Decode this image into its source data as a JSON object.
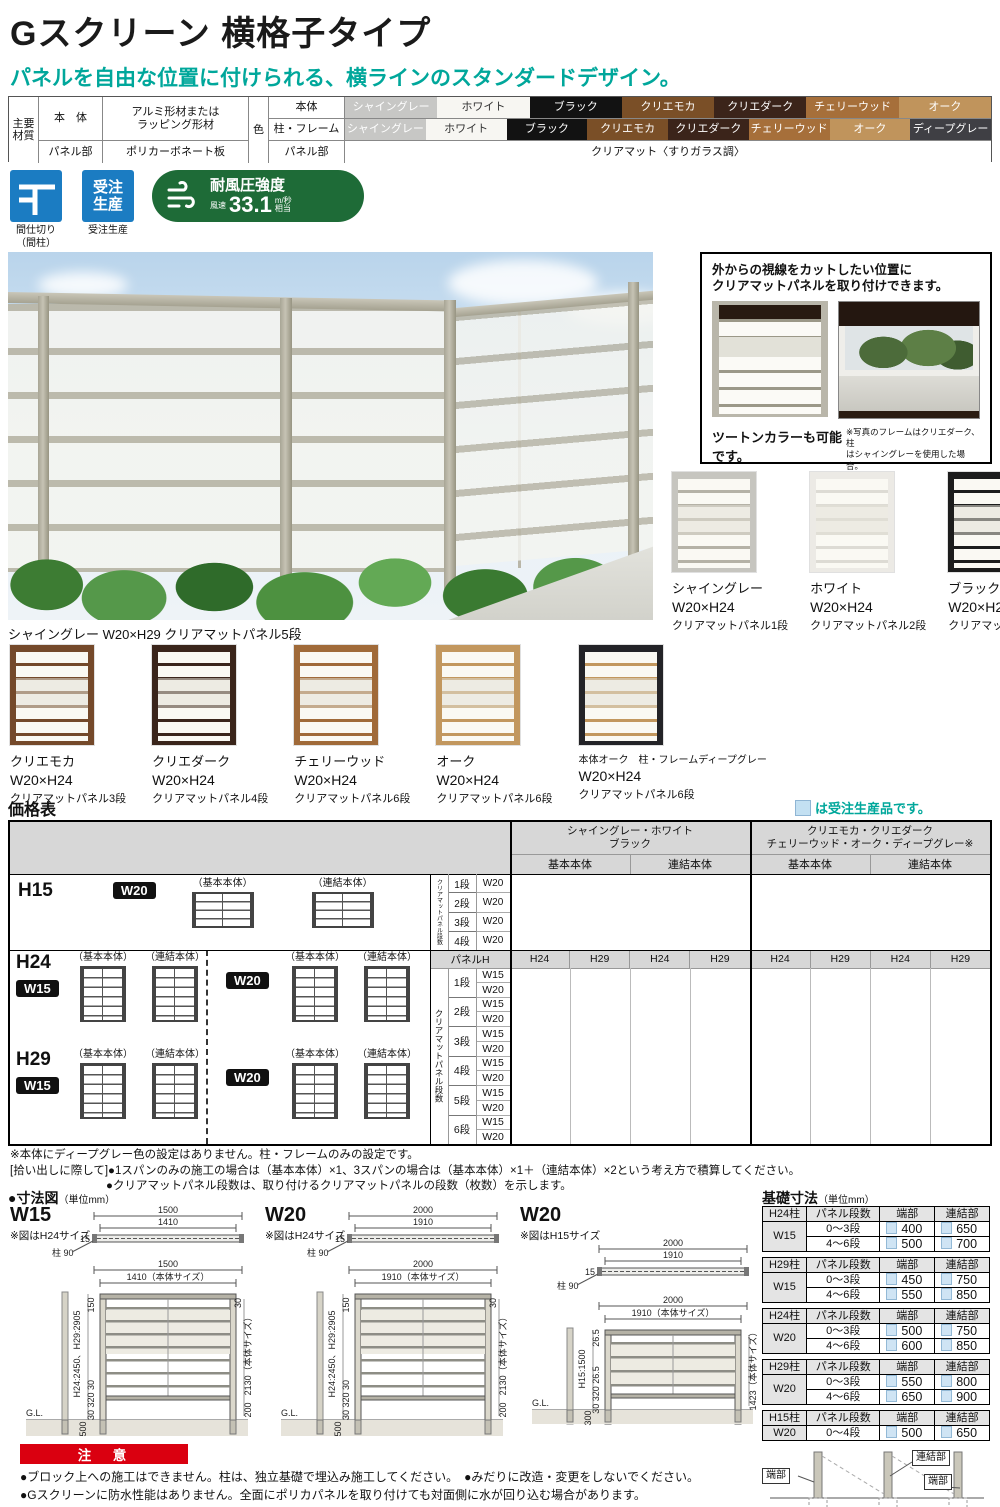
{
  "header": {
    "title": "Gスクリーン 横格子タイプ",
    "subtitle": "パネルを自由な位置に付けられる、横ラインのスタンダードデザイン。"
  },
  "spec": {
    "main_l1": "主要",
    "main_l2": "材質",
    "body_label": "本　体",
    "body_value_l1": "アルミ形材または",
    "body_value_l2": "ラッピング形材",
    "panel_label": "パネル部",
    "panel_value": "ポリカーボネート板",
    "color_label": "色",
    "row1_label": "本体",
    "row2_label": "柱・フレーム",
    "row3_label": "パネル部",
    "row3_value": "クリアマット〈すりガラス調〉",
    "row1": [
      {
        "name": "シャイングレー",
        "bg": "#c7c7c5",
        "fg": "#ffffff"
      },
      {
        "name": "ホワイト",
        "bg": "#f7f6f2",
        "fg": "#333333"
      },
      {
        "name": "ブラック",
        "bg": "#121212",
        "fg": "#ffffff"
      },
      {
        "name": "クリエモカ",
        "bg": "#7a4f27",
        "fg": "#ffffff"
      },
      {
        "name": "クリエダーク",
        "bg": "#3b241a",
        "fg": "#ffffff"
      },
      {
        "name": "チェリーウッド",
        "bg": "#a66f3a",
        "fg": "#ffffff"
      },
      {
        "name": "オーク",
        "bg": "#c0945c",
        "fg": "#ffffff"
      }
    ],
    "row2": [
      {
        "name": "シャイングレー",
        "bg": "#c7c7c5",
        "fg": "#ffffff"
      },
      {
        "name": "ホワイト",
        "bg": "#f7f6f2",
        "fg": "#333333"
      },
      {
        "name": "ブラック",
        "bg": "#121212",
        "fg": "#ffffff"
      },
      {
        "name": "クリエモカ",
        "bg": "#7a4f27",
        "fg": "#ffffff"
      },
      {
        "name": "クリエダーク",
        "bg": "#3b241a",
        "fg": "#ffffff"
      },
      {
        "name": "チェリーウッド",
        "bg": "#a66f3a",
        "fg": "#ffffff"
      },
      {
        "name": "オーク",
        "bg": "#c0945c",
        "fg": "#ffffff"
      },
      {
        "name": "ディープグレー",
        "bg": "#3f3f44",
        "fg": "#ffffff"
      }
    ]
  },
  "badges": {
    "partition_label_l1": "間仕切り",
    "partition_label_l2": "（間柱）",
    "order_icon_l1": "受注",
    "order_icon_l2": "生産",
    "order_label": "受注生産",
    "wind_title": "耐風圧強度",
    "wind_prefix": "風速",
    "wind_value": "33.1",
    "wind_unit": "m/秒",
    "wind_suffix": "相当"
  },
  "photo": {
    "caption": "シャイングレー W20×H29 クリアマットパネル5段"
  },
  "callout": {
    "t1": "外からの視線をカットしたい位置に",
    "t2": "クリアマットパネルを取り付けできます。",
    "cap": "ツートンカラーも可能です。",
    "note1": "※写真のフレームはクリエダーク、柱",
    "note2": "はシャイングレーを使用した場合。"
  },
  "trio": [
    {
      "name": "シャイングレー",
      "size": "W20×H24",
      "panel": "クリアマットパネル1段",
      "frame": "#c6c5bf",
      "rail": "#b5b2a6"
    },
    {
      "name": "ホワイト",
      "size": "W20×H24",
      "panel": "クリアマットパネル2段",
      "frame": "#eceae5",
      "rail": "#dddbd4"
    },
    {
      "name": "ブラック",
      "size": "W20×H24",
      "panel": "クリアマットパネル2段",
      "frame": "#1c1c1c",
      "rail": "#1c1c1c"
    }
  ],
  "bottom": [
    {
      "name": "クリエモカ",
      "size": "W20×H24",
      "panel": "クリアマットパネル3段",
      "frame": "#74492a",
      "rail": "#74492a"
    },
    {
      "name": "クリエダーク",
      "size": "W20×H24",
      "panel": "クリアマットパネル4段",
      "frame": "#3a251b",
      "rail": "#3a251b"
    },
    {
      "name": "チェリーウッド",
      "size": "W20×H24",
      "panel": "クリアマットパネル6段",
      "frame": "#a06a39",
      "rail": "#a06a39"
    },
    {
      "name": "オーク",
      "size": "W20×H24",
      "panel": "クリアマットパネル6段",
      "frame": "#c2975e",
      "rail": "#c2975e"
    },
    {
      "name": "本体オーク　柱・フレームディープグレー",
      "size": "W20×H24",
      "panel": "クリアマットパネル6段",
      "frame": "#232327",
      "rail": "#c2975e"
    }
  ],
  "price": {
    "title": "価格表",
    "legend": "は受注生産品です。",
    "groups": [
      {
        "l1": "シャイングレー・ホワイト",
        "l2": "ブラック"
      },
      {
        "l1": "クリエモカ・クリエダーク",
        "l2": "チェリーウッド・オーク・ディープグレー※"
      }
    ],
    "sub_basic": "基本本体",
    "sub_joint": "連結本体",
    "panel_h": "パネルH",
    "panel_h_cols": [
      "H24",
      "H29",
      "H24",
      "H29",
      "H24",
      "H29",
      "H24",
      "H29"
    ],
    "h15_label": "H15",
    "h24_label": "H24",
    "h29_label": "H29",
    "w15": "W15",
    "w20": "W20",
    "basic": "（基本本体）",
    "joint": "（連結本体）",
    "side_label": "クリアマットパネル段数",
    "dan": [
      "1段",
      "2段",
      "3段",
      "4段",
      "5段",
      "6段"
    ]
  },
  "notes": [
    "※本体にディープグレー色の設定はありません。柱・フレームのみの設定です。",
    "[拾い出しに際して]●1スパンのみの施工の場合は（基本本体）×1、3スパンの場合は（基本本体）×1＋（連結本体）×2という考え方で積算してください。",
    "●クリアマットパネル段数は、取り付けるクリアマットパネルの段数（枚数）を示します。"
  ],
  "dims": {
    "heading": "●寸法図",
    "unit": "（単位mm）",
    "d1": {
      "name": "W15",
      "note": "※図はH24サイズ",
      "plan_total": "1500",
      "plan_inner": "1410",
      "plan_t": "15",
      "post": "柱 90",
      "f_total": "1500",
      "f_inner": "1410（本体サイズ）",
      "top": "150",
      "t30": "30",
      "hgt": "H24:2450、H29:2905",
      "body": "2130（本体サイズ）",
      "bot": "30 320 30",
      "gnd": "200",
      "embed": "500",
      "gl": "G.L."
    },
    "d2": {
      "name": "W20",
      "note": "※図はH24サイズ",
      "plan_total": "2000",
      "plan_inner": "1910",
      "plan_t": "15",
      "post": "柱 90",
      "f_total": "2000",
      "f_inner": "1910（本体サイズ）",
      "top": "150",
      "t30": "30",
      "hgt": "H24:2450、H29:2905",
      "body": "2130（本体サイズ）",
      "bot": "30 320 30",
      "gnd": "200",
      "embed": "500",
      "gl": "G.L."
    },
    "d3": {
      "name": "W20",
      "note": "※図はH15サイズ",
      "plan_total": "2000",
      "plan_inner": "1910",
      "plan_t": "15",
      "post": "柱 90",
      "f_total": "2000",
      "f_inner": "1910（本体サイズ）",
      "top": "26.5",
      "hgt": "H15:1500",
      "body": "1423（本体サイズ）",
      "bot": "30 320 26.5",
      "embed": "300",
      "gl": "G.L."
    }
  },
  "foundation": {
    "heading": "基礎寸法",
    "unit": "（単位mm）",
    "headers": [
      "パネル段数",
      "端部",
      "連結部"
    ],
    "tables": [
      {
        "post": "H24柱",
        "w": "W15",
        "rows": [
          [
            "0〜3段",
            "400",
            "650"
          ],
          [
            "4〜6段",
            "500",
            "700"
          ]
        ]
      },
      {
        "post": "H29柱",
        "w": "W15",
        "rows": [
          [
            "0〜3段",
            "450",
            "750"
          ],
          [
            "4〜6段",
            "550",
            "850"
          ]
        ]
      },
      {
        "post": "H24柱",
        "w": "W20",
        "rows": [
          [
            "0〜3段",
            "500",
            "750"
          ],
          [
            "4〜6段",
            "600",
            "850"
          ]
        ]
      },
      {
        "post": "H29柱",
        "w": "W20",
        "rows": [
          [
            "0〜3段",
            "550",
            "800"
          ],
          [
            "4〜6段",
            "650",
            "900"
          ]
        ]
      },
      {
        "post": "H15柱",
        "w": "W20",
        "rows": [
          [
            "0〜4段",
            "500",
            "650"
          ]
        ]
      }
    ],
    "diagram": {
      "left": "端部",
      "join": "連結部",
      "right": "端部"
    }
  },
  "caution": {
    "title": "注　意",
    "l1": "●ブロック上への施工はできません。柱は、独立基礎で埋込み施工してください。　●みだりに改造・変更をしないでください。",
    "l2": "●Gスクリーンに防水性能はありません。全面にポリカパネルを取り付けても対面側に水が回り込む場合があります。"
  },
  "colors": {
    "accent_teal": "#00a79b",
    "badge_blue": "#1b7cc2",
    "badge_green": "#1e6b37",
    "caution_red": "#da0010",
    "legend_blue": "#c3e0f2",
    "table_header_gray": "#d7d7d7"
  }
}
